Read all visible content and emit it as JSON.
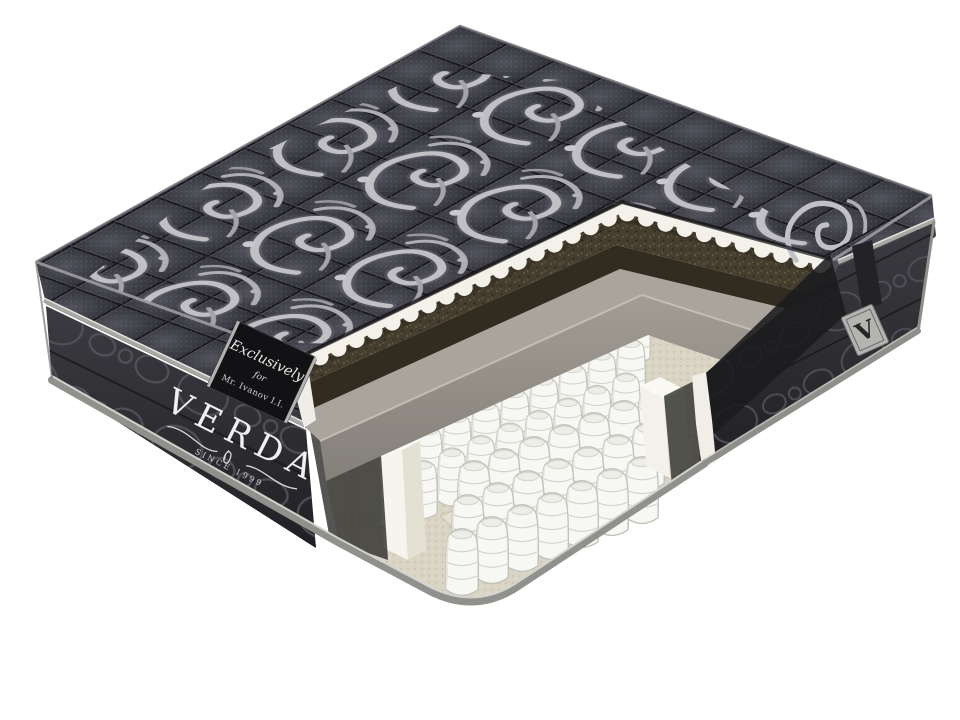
{
  "product": {
    "brand": "VERDA",
    "since": "SINCE 1999",
    "label": {
      "line1": "Exclusively",
      "line2": "for",
      "line3": "Mr. Ivanov I.I."
    },
    "corner_tag_letter": "V"
  },
  "palette": {
    "background": "#ffffff",
    "top_fabric": "#3c3c44",
    "side_fabric": "#2c2c31",
    "damask_silver": "#c3c3c9",
    "quilt_seam": "#15151a",
    "scallop_foam": "#f3f1ea",
    "coir_brown": "#453e2f",
    "coir_face": "#322c20",
    "foam_gray_top": "#a9a59c",
    "foam_gray_face": "#918d84",
    "felt_beige": "#d9d4c4",
    "spring_white": "#f7f7f4",
    "binding_gray": "#90908c",
    "label_black": "#121215",
    "tag_gray": "#b4b4b1"
  }
}
